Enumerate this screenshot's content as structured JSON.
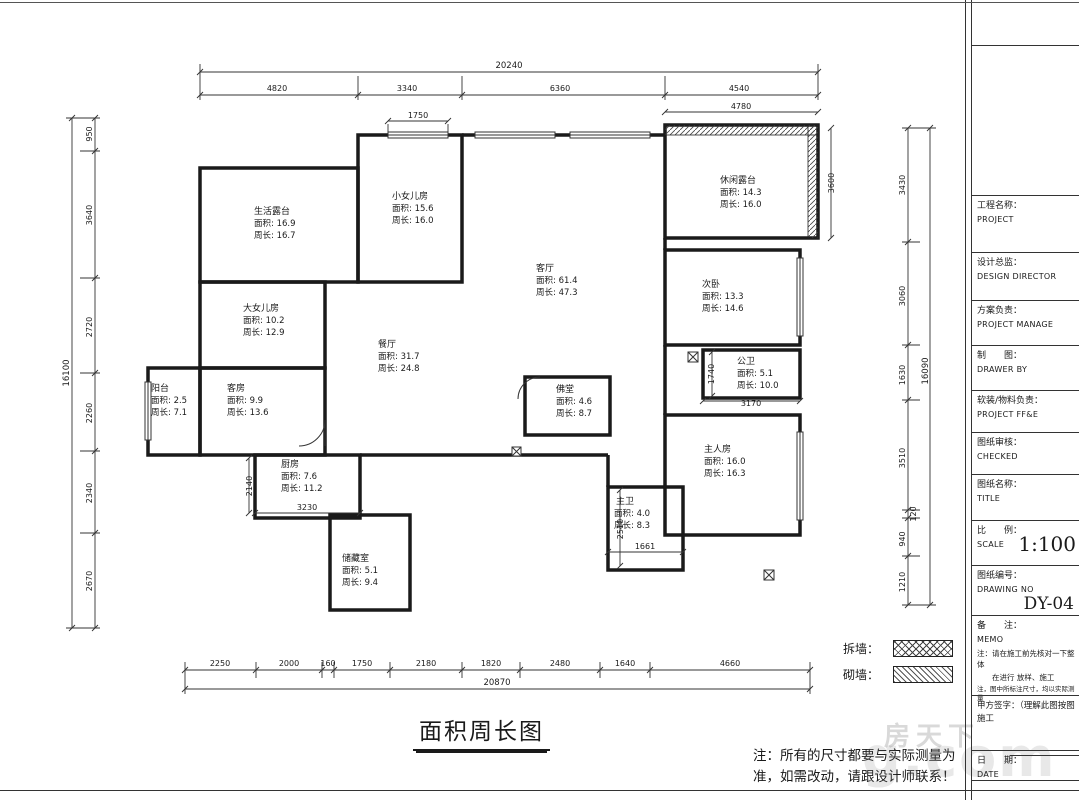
{
  "title": "面积周长图",
  "note": {
    "line1": "注：所有的尺寸都要与实际测量为",
    "line2": "准，如需改动，请跟设计师联系！"
  },
  "legend": {
    "demolish": "拆墙：",
    "build": "砌墙："
  },
  "rooms": [
    {
      "name": "生活露台",
      "area": "面积: 16.9",
      "perimeter": "周长: 16.7"
    },
    {
      "name": "小女儿房",
      "area": "面积: 15.6",
      "perimeter": "周长: 16.0"
    },
    {
      "name": "休闲露台",
      "area": "面积: 14.3",
      "perimeter": "周长: 16.0"
    },
    {
      "name": "客厅",
      "area": "面积: 61.4",
      "perimeter": "周长: 47.3"
    },
    {
      "name": "次卧",
      "area": "面积: 13.3",
      "perimeter": "周长: 14.6"
    },
    {
      "name": "大女儿房",
      "area": "面积: 10.2",
      "perimeter": "周长: 12.9"
    },
    {
      "name": "餐厅",
      "area": "面积: 31.7",
      "perimeter": "周长: 24.8"
    },
    {
      "name": "阳台",
      "area": "面积: 2.5",
      "perimeter": "周长: 7.1"
    },
    {
      "name": "客房",
      "area": "面积: 9.9",
      "perimeter": "周长: 13.6"
    },
    {
      "name": "公卫",
      "area": "面积: 5.1",
      "perimeter": "周长: 10.0"
    },
    {
      "name": "佛堂",
      "area": "面积: 4.6",
      "perimeter": "周长: 8.7"
    },
    {
      "name": "主人房",
      "area": "面积: 16.0",
      "perimeter": "周长: 16.3"
    },
    {
      "name": "厨房",
      "area": "面积: 7.6",
      "perimeter": "周长: 11.2"
    },
    {
      "name": "主卫",
      "area": "面积: 4.0",
      "perimeter": "周长: 8.3"
    },
    {
      "name": "储藏室",
      "area": "面积: 5.1",
      "perimeter": "周长: 9.4"
    }
  ],
  "dims": {
    "top_total": "20240",
    "top_segments": [
      "4820",
      "3340",
      "6360",
      "4540"
    ],
    "bottom_total": "20870",
    "bottom_segments": [
      "2250",
      "2000",
      "160",
      "1750",
      "2180",
      "1820",
      "2480",
      "1640",
      "4660"
    ],
    "left_total": "16100",
    "left_segments": [
      "950",
      "3640",
      "2720",
      "2260",
      "2340",
      "2670"
    ],
    "right_total": "16090",
    "right_segments": [
      "3430",
      "3060",
      "1630",
      "3510",
      "120",
      "940",
      "1210"
    ],
    "inner": {
      "girl_window": "1750",
      "terrace_top": "4780",
      "terrace_right": "3600",
      "pubbath_v": "1740",
      "pubbath_b": "3170",
      "kitchen_v": "2140",
      "kitchen_b": "3230",
      "mbath_v": "2510",
      "mbath_b": "1661"
    }
  },
  "titleblock": {
    "rows": [
      {
        "label": "工程名称：",
        "sub": "PROJECT"
      },
      {
        "label": "设计总监：",
        "sub": "DESIGN DIRECTOR"
      },
      {
        "label": "方案负责：",
        "sub": "PROJECT MANAGE"
      },
      {
        "label": "制　　图：",
        "sub": "DRAWER BY"
      },
      {
        "label": "软装/物料负责：",
        "sub": "PROJECT FF&E"
      },
      {
        "label": "图纸审核：",
        "sub": "CHECKED"
      },
      {
        "label": "图纸名称：",
        "sub": "TITLE"
      },
      {
        "label": "比　　例：",
        "sub": "SCALE",
        "value": "1:100"
      },
      {
        "label": "图纸编号：",
        "sub": "DRAWING NO",
        "value": "DY-04"
      }
    ],
    "memo_label": "备　　注：",
    "memo_sub": "MEMO",
    "memo_note1": "注：请在施工前先核对一下整体",
    "memo_note2": "　　在进行 放样、施工",
    "memo_note3": "注，图中所标注尺寸，均以实际测量",
    "sign_label": "甲方签字：（理解此图按图施工",
    "date_label": "日　　期：",
    "date_sub": "DATE"
  },
  "watermark": {
    "cn": "房天下",
    "en": "g.com"
  }
}
